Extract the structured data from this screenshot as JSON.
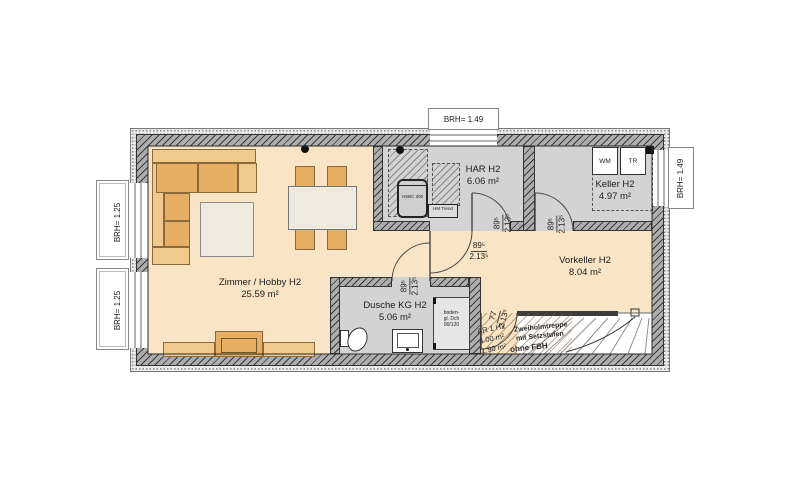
{
  "rooms": {
    "zimmer": {
      "name": "Zimmer / Hobby H2",
      "area": "25.59 m²"
    },
    "har": {
      "name": "HAR H2",
      "area": "6.06 m²"
    },
    "keller": {
      "name": "Keller H2",
      "area": "4.97 m²"
    },
    "vorkeller": {
      "name": "Vorkeller H2",
      "area": "8.04 m²"
    },
    "dusche": {
      "name": "Dusche KG H2",
      "area": "5.06 m²"
    },
    "ar": {
      "name": "AR 1 H2",
      "area1": "4.00 m²",
      "area2": "1.90 m²"
    }
  },
  "windows": {
    "left_upper": "BRH= 1.25",
    "left_lower": "BRH= 1.25",
    "top": "BRH= 1.49",
    "right": "BRH= 1.49"
  },
  "doors": {
    "zimmer_vorkeller": {
      "w": "89⁵",
      "h": "2.13⁵"
    },
    "dusche": {
      "w": "89⁵",
      "h": "2.13⁵"
    },
    "har": {
      "w": "89⁵",
      "h": "2.13⁵"
    },
    "keller": {
      "w": "89⁵",
      "h": "2.13⁵"
    },
    "ar": {
      "w": "77",
      "h": "2.13⁵"
    }
  },
  "equipment": {
    "tank": "HSBC 300",
    "heating_unit": "HM Trend",
    "washing_machine": "WM",
    "dryer": "TR",
    "shower": {
      "line1": "boden-",
      "line2": "gl. Dch",
      "line3": "90/120"
    }
  },
  "stair": {
    "note_line1": "Zweiholmtreppe",
    "note_line2": "mit Setzstufen",
    "note_line3": "ohne FBH"
  },
  "colors": {
    "floor_living": "#f9e4c6",
    "floor_utility": "#d3d3d3",
    "furniture_orange": "#e7af63",
    "furniture_light": "#f2c98c",
    "wall_gray": "#adadad"
  }
}
